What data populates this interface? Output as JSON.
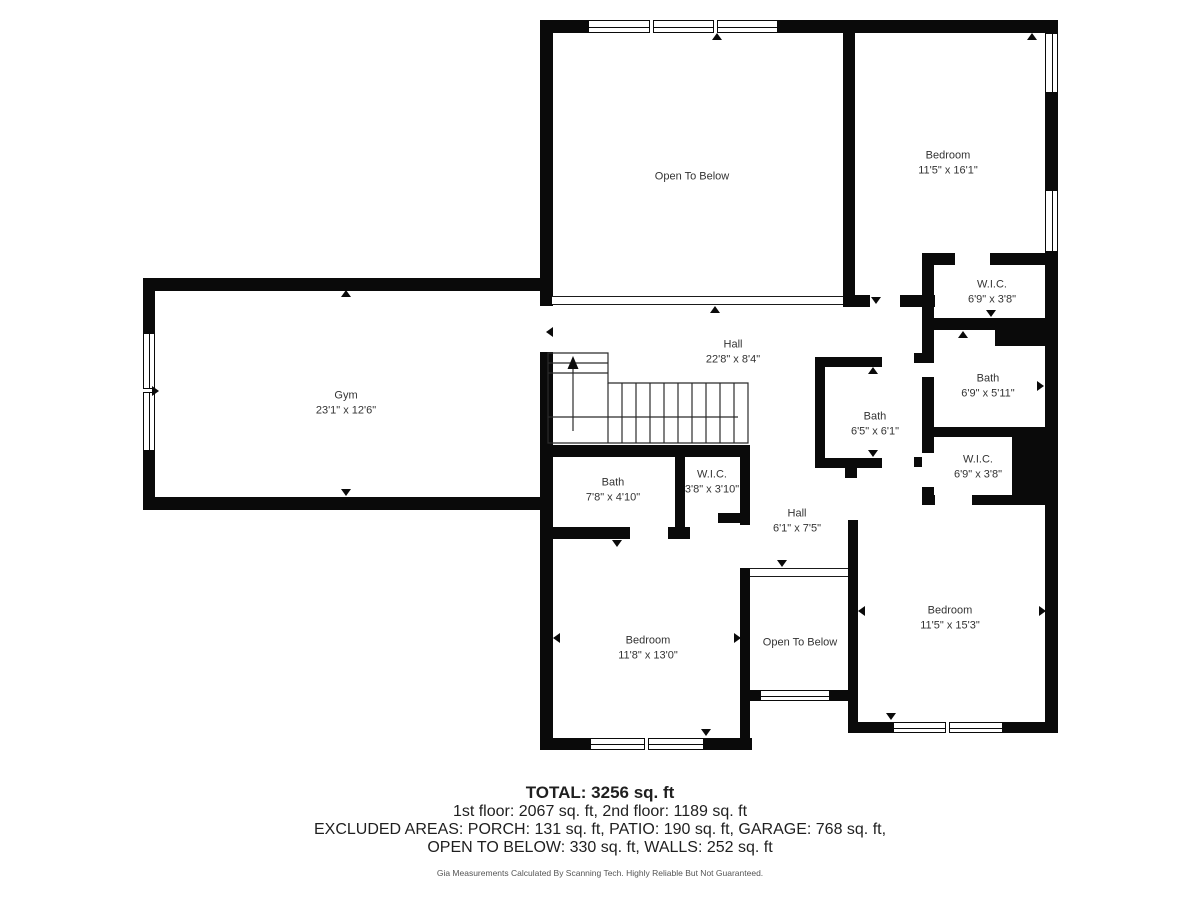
{
  "plan": {
    "rooms": [
      {
        "name": "Open To Below",
        "dims": ""
      },
      {
        "name": "Bedroom",
        "dims": "11'5\" x 16'1\""
      },
      {
        "name": "W.I.C.",
        "dims": "6'9\" x 3'8\""
      },
      {
        "name": "Gym",
        "dims": "23'1\" x 12'6\""
      },
      {
        "name": "Hall",
        "dims": "22'8\" x 8'4\""
      },
      {
        "name": "Bath",
        "dims": "6'9\" x 5'11\""
      },
      {
        "name": "Bath",
        "dims": "6'5\" x 6'1\""
      },
      {
        "name": "W.I.C.",
        "dims": "6'9\" x 3'8\""
      },
      {
        "name": "Bath",
        "dims": "7'8\" x 4'10\""
      },
      {
        "name": "W.I.C.",
        "dims": "3'8\" x 3'10\""
      },
      {
        "name": "Hall",
        "dims": "6'1\" x 7'5\""
      },
      {
        "name": "Bedroom",
        "dims": "11'8\" x 13'0\""
      },
      {
        "name": "Open To Below",
        "dims": ""
      },
      {
        "name": "Bedroom",
        "dims": "11'5\" x 15'3\""
      }
    ]
  },
  "footer": {
    "total": "TOTAL: 3256 sq. ft",
    "floors": "1st floor: 2067 sq. ft, 2nd floor: 1189 sq. ft",
    "excluded": "EXCLUDED AREAS: PORCH: 131 sq. ft, PATIO: 190 sq. ft, GARAGE: 768 sq. ft,",
    "open_below": "OPEN TO BELOW: 330 sq. ft, WALLS: 252 sq. ft",
    "disclaimer": "Gia Measurements Calculated By Scanning Tech. Highly Reliable But Not Guaranteed."
  },
  "colors": {
    "wall": "#0a0a0a",
    "label_text": "#333333",
    "background": "#ffffff"
  }
}
